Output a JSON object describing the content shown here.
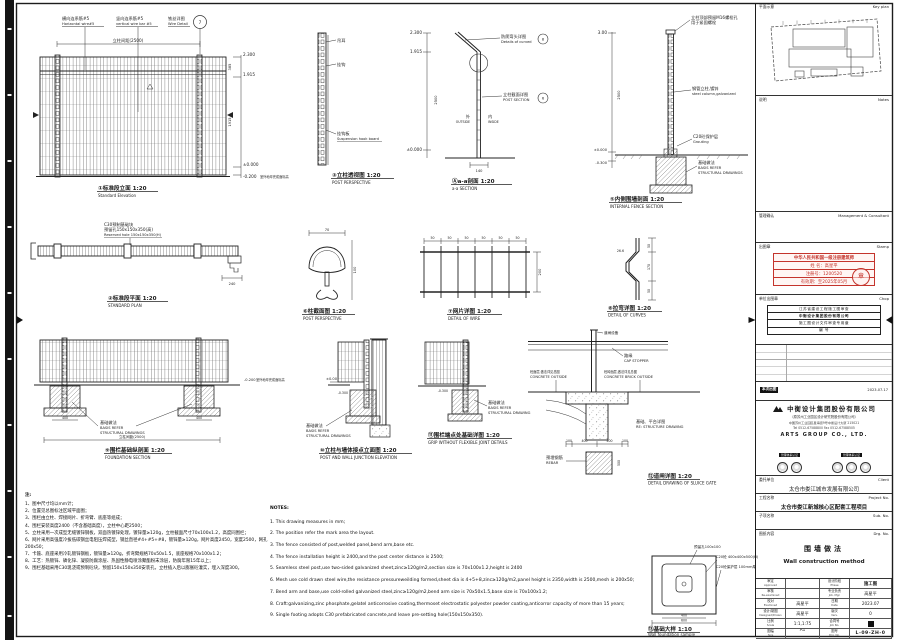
{
  "views": {
    "v1": {
      "title": "①标准段立面 1:20",
      "title_en": "Standard Elevation",
      "c1": "横向连系筋#5",
      "c1e": "Horizontal wire#5",
      "c2": "竖向连系筋#5",
      "c2e": "vertical wire bar #5",
      "c3": "铁丝详图",
      "c3e": "Wire Detail",
      "ref": "7",
      "dim_top": "立柱间距(2500)",
      "lv1": "2.300",
      "lv2": "1.915",
      "lv3": "±0.000",
      "lv4": "-0.200",
      "lv4n": "室外地坪完成面标高",
      "seg1": "385",
      "seg2": "1915"
    },
    "v2": {
      "title": "②标准段平面 1:20",
      "title_en": "STANDARD PLAN",
      "c1": "C30预制基础块",
      "c2": "预留孔150x150x350(高)",
      "c1e": "Reserved hole 150x150x350(H)",
      "dim": "240"
    },
    "v3": {
      "title": "③立柱透视图 1:20",
      "title_en": "POST PERSPECTIVE",
      "l1": "吊耳",
      "l2": "挂钩",
      "l3": "挂钩板",
      "l3e": "Suspension hook board"
    },
    "va": {
      "title": "Ⓐa-a剖面 1:20",
      "title_en": "a-a SECTION",
      "c1": "防爬弯头详图",
      "c1e": "Details of curved",
      "r1": "8",
      "c2": "立柱截面详图",
      "c2e": "POST SECTION",
      "r2": "6",
      "out": "外",
      "oute": "OUTSIDE",
      "inn": "内",
      "inne": "INSIDE",
      "lv1": "2.300",
      "lv2": "1.915",
      "lv3": "±0.000",
      "dimb": "140",
      "dimh": "2500"
    },
    "v5": {
      "title": "⑤内侧围墙剖面 1:20",
      "title_en": "INTERNAL FENCE SECTION",
      "t1": "立柱顶部预留M16螺栓孔",
      "t2": "用于紧固螺栓",
      "c1": "钢管立柱,镀锌",
      "c1e": "steel column,galvanized",
      "c2": "C20砼保护层",
      "c2e": "Grouting",
      "b1": "基础做法",
      "b2": "BASIS REFER",
      "b3": "STRUCTURAL DRAWINGS",
      "lv1": "3.00",
      "dimh": "2500",
      "lv2": "±0.000",
      "lv3": "-0.300"
    },
    "v6": {
      "title": "⑥柱截面图 1:20",
      "title_en": "POST PERSPECTIVE",
      "d1": "70",
      "d2": "100"
    },
    "v7": {
      "title": "⑦网片详图 1:20",
      "title_en": "DETAIL OF WIRE",
      "d50": "50",
      "d200": "200"
    },
    "v8": {
      "title": "⑧拉弯详图 1:20",
      "title_en": "DETAIL OF CURVES",
      "ang": "26.6",
      "s1": "50",
      "s2": "170",
      "s3": "50"
    },
    "v9": {
      "title": "⑨围栏基础纵剖面 1:20",
      "title_en": "FOUNDATION SECTION",
      "b1": "基础做法",
      "b2": "BASIS REFER",
      "b3": "STRUCTURAL DRAWINGS",
      "d400": "400",
      "dtot": "立柱间距(2500)",
      "lv": "-0.200",
      "lvn": "室外地坪完成面标高"
    },
    "v10": {
      "title": "⑩立柱与墙体接点立面图 1:20",
      "title_en": "POST AND WALL JUNCTION ELEVATION",
      "lv1": "±0.00",
      "lv2": "-0.300",
      "b1": "基础做法",
      "b2": "BASIS REFER",
      "b3": "STRUCTURAL DRAWINGS"
    },
    "v11": {
      "title": "⑪围栏端点处基础详图 1:20",
      "title_en": "GRIP WITHOUT FLEXIBLE JOINT DETAILS",
      "b1": "基础做法",
      "b2": "BASIS REFER",
      "b3": "STRUCTURAL DRAWING",
      "lv": "-0.300"
    },
    "v12": {
      "title": "⑫道闸详图 1:20",
      "title_en": "DETAIL DRAWING OF SLUICE GATE",
      "top": "道闸设备",
      "cap": "路缘",
      "cape": "CAP STOPPER",
      "l1": "砼面层,做法详见总图",
      "l1e": "CONCRETE OUTSIDE",
      "r1": "砼砖面层,做法详见总图",
      "r1e": "CONCRETE BRICK OUTSIDE",
      "s1": "基础、平台详图",
      "s1e": "RE: STRUCTURE DRAWING",
      "rb": "预埋钢筋",
      "rbe": "REBAR",
      "d1": "100",
      "d2": "400",
      "d3": "400",
      "d4": "100",
      "d5": "500"
    },
    "v13": {
      "title": "⑬基础大样 1:10",
      "title_en": "Wall foundation sample",
      "l1": "预留孔100x100",
      "r1": "C20砼 400x400x500(H)",
      "r2": "C20砼保护层 100mm厚",
      "d400": "400",
      "d600": "600"
    }
  },
  "notes_cn": {
    "header": "注:",
    "items": [
      "1、图中尺寸均以mm计；",
      "2、位置见总图标注区域平面图；",
      "3、围栏由立柱、焊接网片、折弯臂、底座等组成；",
      "4、围栏安装高度2400（不含基础高度），立柱中心距2500；",
      "5、立柱采用一次成型无缝镀锌钢板，双面热镀锌处理，镀锌量≥120g，立柱截面尺寸70x100x1.2，高度同围栏；",
      "6、网片采用高强度冷拔低碳钢丝电阻压焊成型，钢丝直径#4+#5+#8，镀锌量≥120g，网片高度2450，宽度2500，网孔200x50；",
      "7、卡箍、底座采用冷轧镀锌钢板，镀锌量≥120g，折弯臂规格70x50x1.5，底座规格70x100x1.2；",
      "8、工艺：热镀锌、磷化锌、凝胶防腐涂层、热固性静电喷涂聚酯粉末涂层，防腐年限15年以上；",
      "9、围栏基础采用C30现浇或预制砼块，预留150x150x350安装孔，立柱插入后以膨胀砼灌实，埋入深度300。"
    ]
  },
  "notes_en": {
    "header": "NOTES:",
    "items": [
      "1. This drawing measures in mm;",
      "2. The position refer the mark area the layout.",
      "3. The fence consisted of post,welded panel,bend arm,base etc.",
      "4. The fence installation height is 2400,and the post center distance is 2500;",
      "5. Seamless steel post,use two-sided galvanized sheet,zinc≥120g/m2,section size is 70x100x1.2,height is 2400",
      "6. Mesh use cold drawn steel wire,the resistance pressureweilding formed,sheet dia is 4+5+8,zinc≥120g/m2,panel height is 2350,width is 2500,mesh is 200x50;",
      "7. Bend arm and base,use cold-rolled galvanized steel,zinc≥120g/m2,bend arm size is 70x50x1.5,base size is 70x100x1.2;",
      "8. Craft:galvanizing,zinc phosphate,gelatel anticorrosive coating,thermoset electrostatic polyester powder coating,anticorror capacity of more than 15 years;",
      "9. Single footing adopts C30 prefabricated concrete,and leave pre-setting hole(150x150x350)."
    ]
  },
  "tb": {
    "keyplan": {
      "cn": "平面示意",
      "en": "Key plan"
    },
    "notes": {
      "cn": "说明",
      "en": "Notes"
    },
    "management": {
      "cn": "管理确认",
      "en": "Management & Consultant"
    },
    "stamp": {
      "cn": "出图章",
      "en": "Stamp",
      "line1": "中华人民共和国一级注册建筑师",
      "name": "姓 名：高星平",
      "reg": "注册号：1200520",
      "valid": "有效期：至2025年05月",
      "seal": "章"
    },
    "chop": {
      "cn": "单位出图章",
      "en": "Chop",
      "r1": "江苏省建设工程施工图审查",
      "r2": "中衡设计集团股份有限公司",
      "r3": "施工图设计文件审查专用章",
      "r4": "编 号"
    },
    "rev": {
      "bar": "本次出图",
      "date": "2023.07.17"
    },
    "company": {
      "name_cn": "中衡设计集团股份有限公司",
      "name_sub": "（原苏州工业园区设计研究院股份有限公司）",
      "addr1": "中国苏州工业园区星海街9号中衡设计大厦 215021",
      "addr2": "Tel 0512-67588800  Fax 0512-67588505",
      "name_en": "ARTS GROUP CO., LTD.",
      "cert_l": "管理体系认证",
      "cert_r": "管理体系认证"
    },
    "client": {
      "cn": "委托单位",
      "en": "Client",
      "value": "太仓市娄江城市发展有限公司"
    },
    "project": {
      "cn": "工程名称",
      "en": "Project No.",
      "value": "太仓市娄江新城核心区配套工程项目"
    },
    "sub": {
      "cn": "子项名称",
      "en": "Sub. No.",
      "value_cn": "L-室外景观",
      "value_en": "L-outdoor Landscape"
    },
    "drg": {
      "cn": "图纸内容",
      "en": "Drg. No.",
      "value_cn": "围墙做法",
      "value_en": "Wall construction method"
    },
    "appr": {
      "r1l": "审定",
      "r1le": "Approved",
      "r1v": "",
      "r1rl": "设计阶段",
      "r1rle": "Phase",
      "r1rv": "施工图",
      "r2l": "审核",
      "r2le": "Re-examined",
      "r2v": "",
      "r2rl": "专业负责",
      "r2rle": "Job. Mgr.",
      "r2rv": "高星平",
      "r3l": "校对",
      "r3le": "Examined",
      "r3v": "高星平",
      "r3rl": "日期",
      "r3rle": "Date",
      "r3rv": "2023.07",
      "r4l": "设计/制图",
      "r4le": "Designed/Drawn",
      "r4v": "高星平",
      "r4rl": "版次",
      "r4rle": "Vers.",
      "r4rv": "0",
      "r5l": "比例",
      "r5le": "Scale",
      "r5v": "1:1,1:75",
      "r5rl": "合同号",
      "r5rle": "Job No.",
      "r6l": "图幅",
      "r6le": "Size",
      "r6v": "A1",
      "discipline": "09",
      "r6rl": "图号",
      "r6rle": "Drg. No.",
      "r6rv": "L-09-ZH-0"
    }
  }
}
